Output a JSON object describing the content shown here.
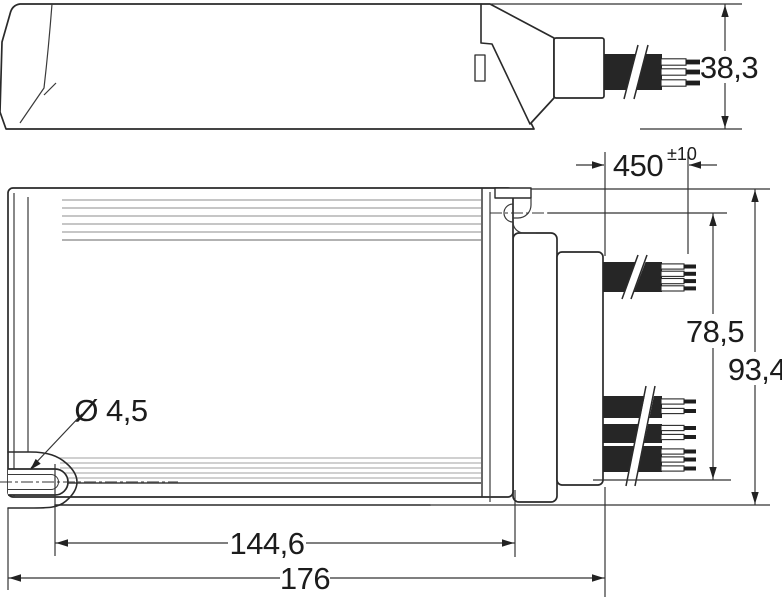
{
  "drawing": {
    "type": "technical-dimension-drawing",
    "side_view": {
      "height_label": "38,3"
    },
    "plan_view": {
      "cable_length_label": "450",
      "cable_length_tolerance_label": "±10",
      "hole_pitch_vertical_label": "78,5",
      "overall_width_label": "93,4",
      "mounting_hole_diameter_label": "Ø 4,5",
      "hole_pitch_horizontal_label": "144,6",
      "overall_length_label": "176"
    },
    "colors": {
      "line": "#2a2a2a",
      "cable_fill": "#262626",
      "fin_line": "#b3b3b3"
    }
  }
}
